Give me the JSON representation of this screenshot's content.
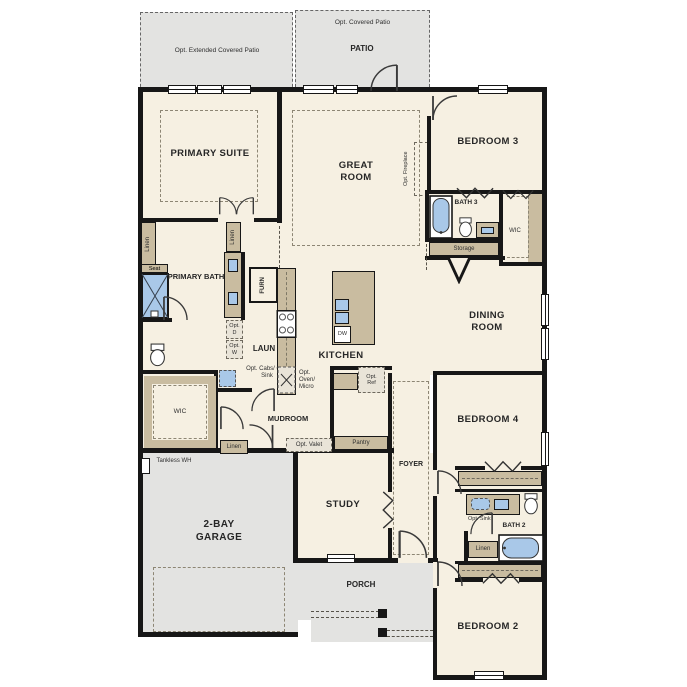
{
  "colors": {
    "floor": "#f6f0e2",
    "outdoor": "#e3e3e1",
    "wall": "#171717",
    "cabinet": "#c9bca0",
    "fixture_blue": "#a9c8e8"
  },
  "labels": {
    "ext_patio": "Opt. Extended Covered Patio",
    "opt_covered_patio": "Opt. Covered Patio",
    "patio": "PATIO",
    "primary_suite": "PRIMARY SUITE",
    "great_room": "GREAT ROOM",
    "opt_fireplace": "Opt. Fireplace",
    "bedroom3": "BEDROOM 3",
    "bath3": "BATH 3",
    "wic_right": "WIC",
    "storage": "Storage",
    "dining_room": "DINING ROOM",
    "linen_left": "Linen",
    "seat": "Seat",
    "primary_bath": "PRIMARY BATH",
    "linen_mid": "Linen",
    "furn": "FURN",
    "opt_d": "Opt. D",
    "opt_w": "Opt. W",
    "laun": "LAUN",
    "opt_cabs_sink": "Opt. Cabs/ Opt. Sink",
    "kitchen": "KITCHEN",
    "dw": "DW",
    "opt_oven_micro": "Opt. Oven/ Micro",
    "opt_ref": "Opt. Ref",
    "mudroom": "MUDROOM",
    "linen_mud": "Linen",
    "opt_valet": "Opt. Valet",
    "pantry": "Pantry",
    "wic_left": "WIC",
    "tankless_wh": "Tankless WH",
    "garage": "2-BAY GARAGE",
    "study": "STUDY",
    "foyer": "FOYER",
    "bedroom4": "BEDROOM 4",
    "opt_sink": "Opt. Sink",
    "bath2": "BATH 2",
    "linen_bath2": "Linen",
    "porch": "PORCH",
    "bedroom2": "BEDROOM 2"
  }
}
